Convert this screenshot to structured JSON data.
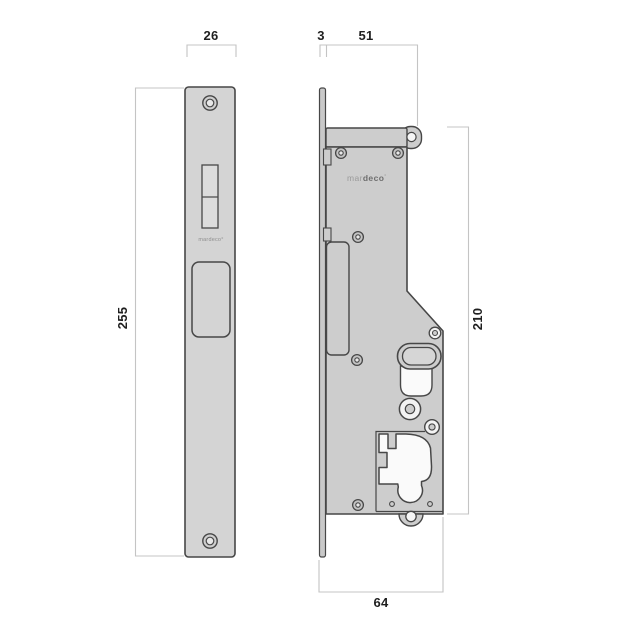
{
  "brand": {
    "prefix": "mar",
    "bold": "deco",
    "mark": "°",
    "full": "mardeco°"
  },
  "dimensions": {
    "front_width": "26",
    "front_height": "255",
    "plate_thickness": "3",
    "body_width": "51",
    "body_height": "210",
    "overall_width": "64"
  },
  "colors": {
    "background": "#ffffff",
    "plate_fill": "#d4d4d4",
    "body_fill": "#cdcdcd",
    "strip_fill": "#c9c9c9",
    "outline": "#474747",
    "cutout_fill": "#fafafa",
    "dimension_line": "#c4c4c4",
    "dimension_text": "#1f1f1f",
    "brand_gray": "#9a9a9a"
  }
}
